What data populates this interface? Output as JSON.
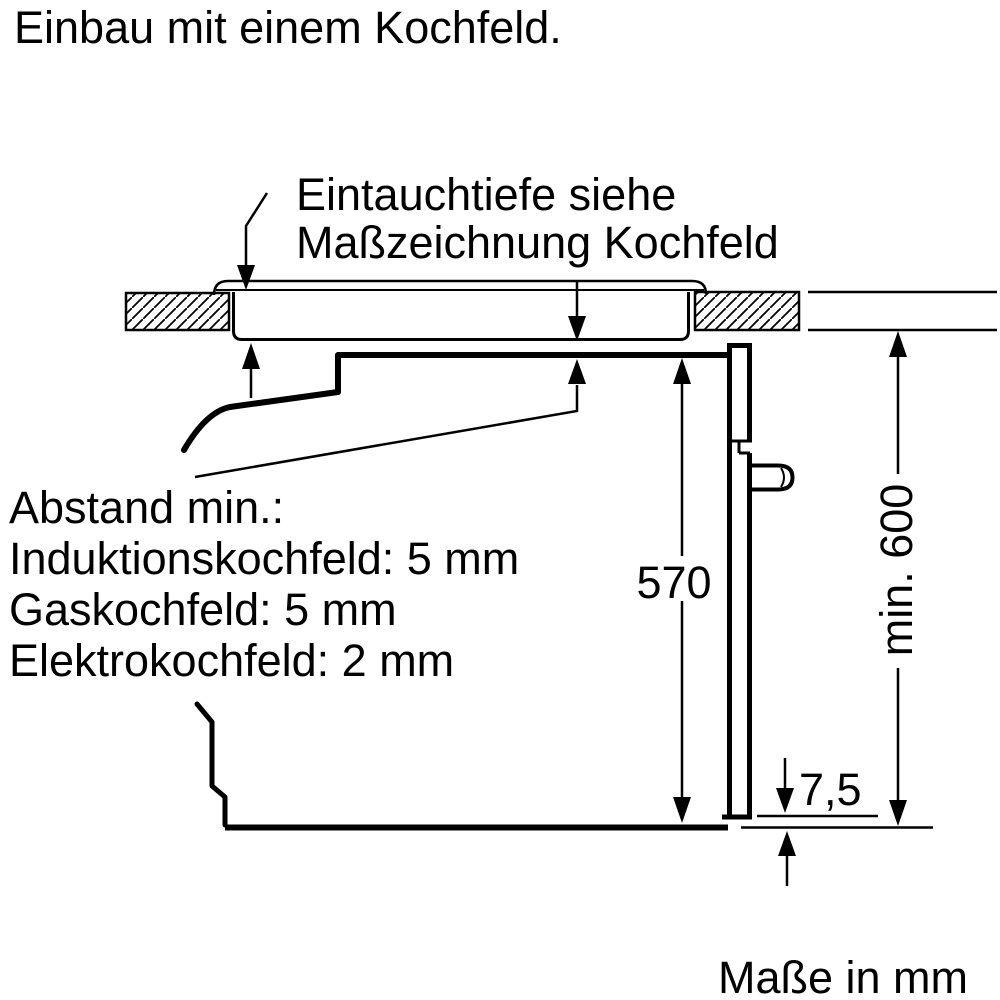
{
  "title": "Einbau mit einem Kochfeld.",
  "footer": "Maße in mm",
  "labels": {
    "immersion_note_line1": "Eintauchtiefe siehe",
    "immersion_note_line2": "Maßzeichnung Kochfeld",
    "clearance_title": "Abstand min.:",
    "clearance_induction": "Induktionskochfeld: 5 mm",
    "clearance_gas": "Gaskochfeld: 5 mm",
    "clearance_electric": "Elektrokochfeld: 2 mm"
  },
  "dimensions": {
    "oven_height": "570",
    "niche_height": "min. 600",
    "door_gap": "7,5"
  },
  "colors": {
    "line": "#000000",
    "background": "#ffffff"
  }
}
